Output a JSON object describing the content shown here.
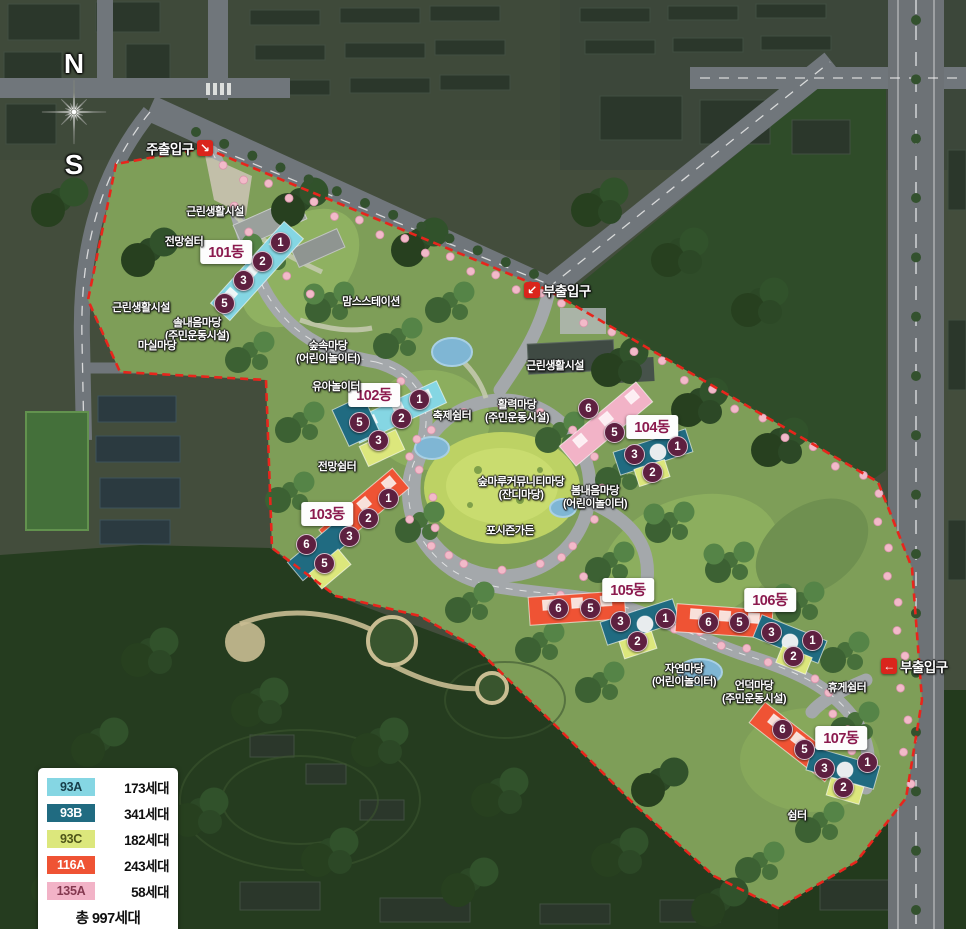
{
  "compass": {
    "north": "N",
    "south": "S"
  },
  "entrances": [
    {
      "id": "main-entrance",
      "label": "주출입구",
      "arrow": "↘",
      "arrow_side": "right",
      "x": 146,
      "y": 138
    },
    {
      "id": "sub-entrance-top",
      "label": "부출입구",
      "arrow": "↙",
      "arrow_side": "left",
      "x": 524,
      "y": 280
    },
    {
      "id": "sub-entrance-right",
      "label": "부출입구",
      "arrow": "←",
      "arrow_side": "left",
      "x": 881,
      "y": 656
    }
  ],
  "buildings": [
    {
      "label": "101동",
      "x": 226,
      "y": 252,
      "units": [
        {
          "n": "1",
          "x": 280,
          "y": 242
        },
        {
          "n": "2",
          "x": 262,
          "y": 261
        },
        {
          "n": "3",
          "x": 243,
          "y": 280
        },
        {
          "n": "5",
          "x": 224,
          "y": 303
        }
      ]
    },
    {
      "label": "102동",
      "x": 374,
      "y": 395,
      "units": [
        {
          "n": "1",
          "x": 419,
          "y": 399
        },
        {
          "n": "2",
          "x": 401,
          "y": 418
        },
        {
          "n": "5",
          "x": 359,
          "y": 422
        },
        {
          "n": "3",
          "x": 378,
          "y": 440
        }
      ]
    },
    {
      "label": "103동",
      "x": 327,
      "y": 514,
      "units": [
        {
          "n": "1",
          "x": 388,
          "y": 498
        },
        {
          "n": "2",
          "x": 368,
          "y": 518
        },
        {
          "n": "3",
          "x": 349,
          "y": 536
        },
        {
          "n": "6",
          "x": 306,
          "y": 544
        },
        {
          "n": "5",
          "x": 324,
          "y": 563
        }
      ]
    },
    {
      "label": "104동",
      "x": 652,
      "y": 427,
      "units": [
        {
          "n": "6",
          "x": 588,
          "y": 408
        },
        {
          "n": "5",
          "x": 614,
          "y": 432
        },
        {
          "n": "3",
          "x": 634,
          "y": 454
        },
        {
          "n": "1",
          "x": 677,
          "y": 446
        },
        {
          "n": "2",
          "x": 652,
          "y": 472
        }
      ]
    },
    {
      "label": "105동",
      "x": 628,
      "y": 590,
      "units": [
        {
          "n": "6",
          "x": 558,
          "y": 608
        },
        {
          "n": "5",
          "x": 590,
          "y": 608
        },
        {
          "n": "3",
          "x": 620,
          "y": 621
        },
        {
          "n": "1",
          "x": 665,
          "y": 618
        },
        {
          "n": "2",
          "x": 637,
          "y": 641
        }
      ]
    },
    {
      "label": "106동",
      "x": 770,
      "y": 600,
      "units": [
        {
          "n": "6",
          "x": 708,
          "y": 622
        },
        {
          "n": "5",
          "x": 739,
          "y": 622
        },
        {
          "n": "3",
          "x": 771,
          "y": 632
        },
        {
          "n": "1",
          "x": 812,
          "y": 640
        },
        {
          "n": "2",
          "x": 793,
          "y": 656
        }
      ]
    },
    {
      "label": "107동",
      "x": 841,
      "y": 738,
      "units": [
        {
          "n": "6",
          "x": 782,
          "y": 729
        },
        {
          "n": "5",
          "x": 804,
          "y": 749
        },
        {
          "n": "3",
          "x": 824,
          "y": 768
        },
        {
          "n": "1",
          "x": 867,
          "y": 762
        },
        {
          "n": "2",
          "x": 843,
          "y": 787
        }
      ]
    }
  ],
  "facilities": [
    {
      "label": "근린생활시설",
      "x": 215,
      "y": 206
    },
    {
      "label": "전망쉼터",
      "x": 184,
      "y": 236
    },
    {
      "label": "근린생활시설",
      "x": 141,
      "y": 302
    },
    {
      "label": "솔내음마당\n(주민운동시설)",
      "x": 197,
      "y": 317
    },
    {
      "label": "마실마당",
      "x": 157,
      "y": 340
    },
    {
      "label": "맘스스테이션",
      "x": 371,
      "y": 296
    },
    {
      "label": "숲속마당\n(어린이놀이터)",
      "x": 328,
      "y": 340
    },
    {
      "label": "유아놀이터",
      "x": 336,
      "y": 381
    },
    {
      "label": "근린생활시설",
      "x": 555,
      "y": 360
    },
    {
      "label": "축제쉼터",
      "x": 452,
      "y": 410
    },
    {
      "label": "활력마당\n(주민운동시설)",
      "x": 517,
      "y": 399
    },
    {
      "label": "전망쉼터",
      "x": 337,
      "y": 461
    },
    {
      "label": "숲마루커뮤니티마당\n(잔디마당)",
      "x": 521,
      "y": 476
    },
    {
      "label": "봄내음마당\n(어린이놀이터)",
      "x": 595,
      "y": 485
    },
    {
      "label": "포시즌가든",
      "x": 510,
      "y": 525
    },
    {
      "label": "자연마당\n(어린이놀이터)",
      "x": 684,
      "y": 663
    },
    {
      "label": "언덕마당\n(주민운동시설)",
      "x": 754,
      "y": 680
    },
    {
      "label": "휴게쉼터",
      "x": 847,
      "y": 682
    },
    {
      "label": "쉼터",
      "x": 797,
      "y": 810
    }
  ],
  "legend": {
    "rows": [
      {
        "type": "93A",
        "count": "173세대",
        "chip_bg": "#85d6e3",
        "chip_fg": "#173f4a"
      },
      {
        "type": "93B",
        "count": "341세대",
        "chip_bg": "#206b81",
        "chip_fg": "#ffffff"
      },
      {
        "type": "93C",
        "count": "182세대",
        "chip_bg": "#dce77c",
        "chip_fg": "#4e5518"
      },
      {
        "type": "116A",
        "count": "243세대",
        "chip_bg": "#ef5334",
        "chip_fg": "#ffffff"
      },
      {
        "type": "135A",
        "count": "58세대",
        "chip_bg": "#f2b3c7",
        "chip_fg": "#84384f"
      }
    ],
    "total": "총 997세대"
  },
  "colors": {
    "unit_circle": "#5e2040",
    "building_label_text": "#8b1a4e",
    "entrance_red": "#da251c",
    "boundary_red": "#e8251c"
  }
}
